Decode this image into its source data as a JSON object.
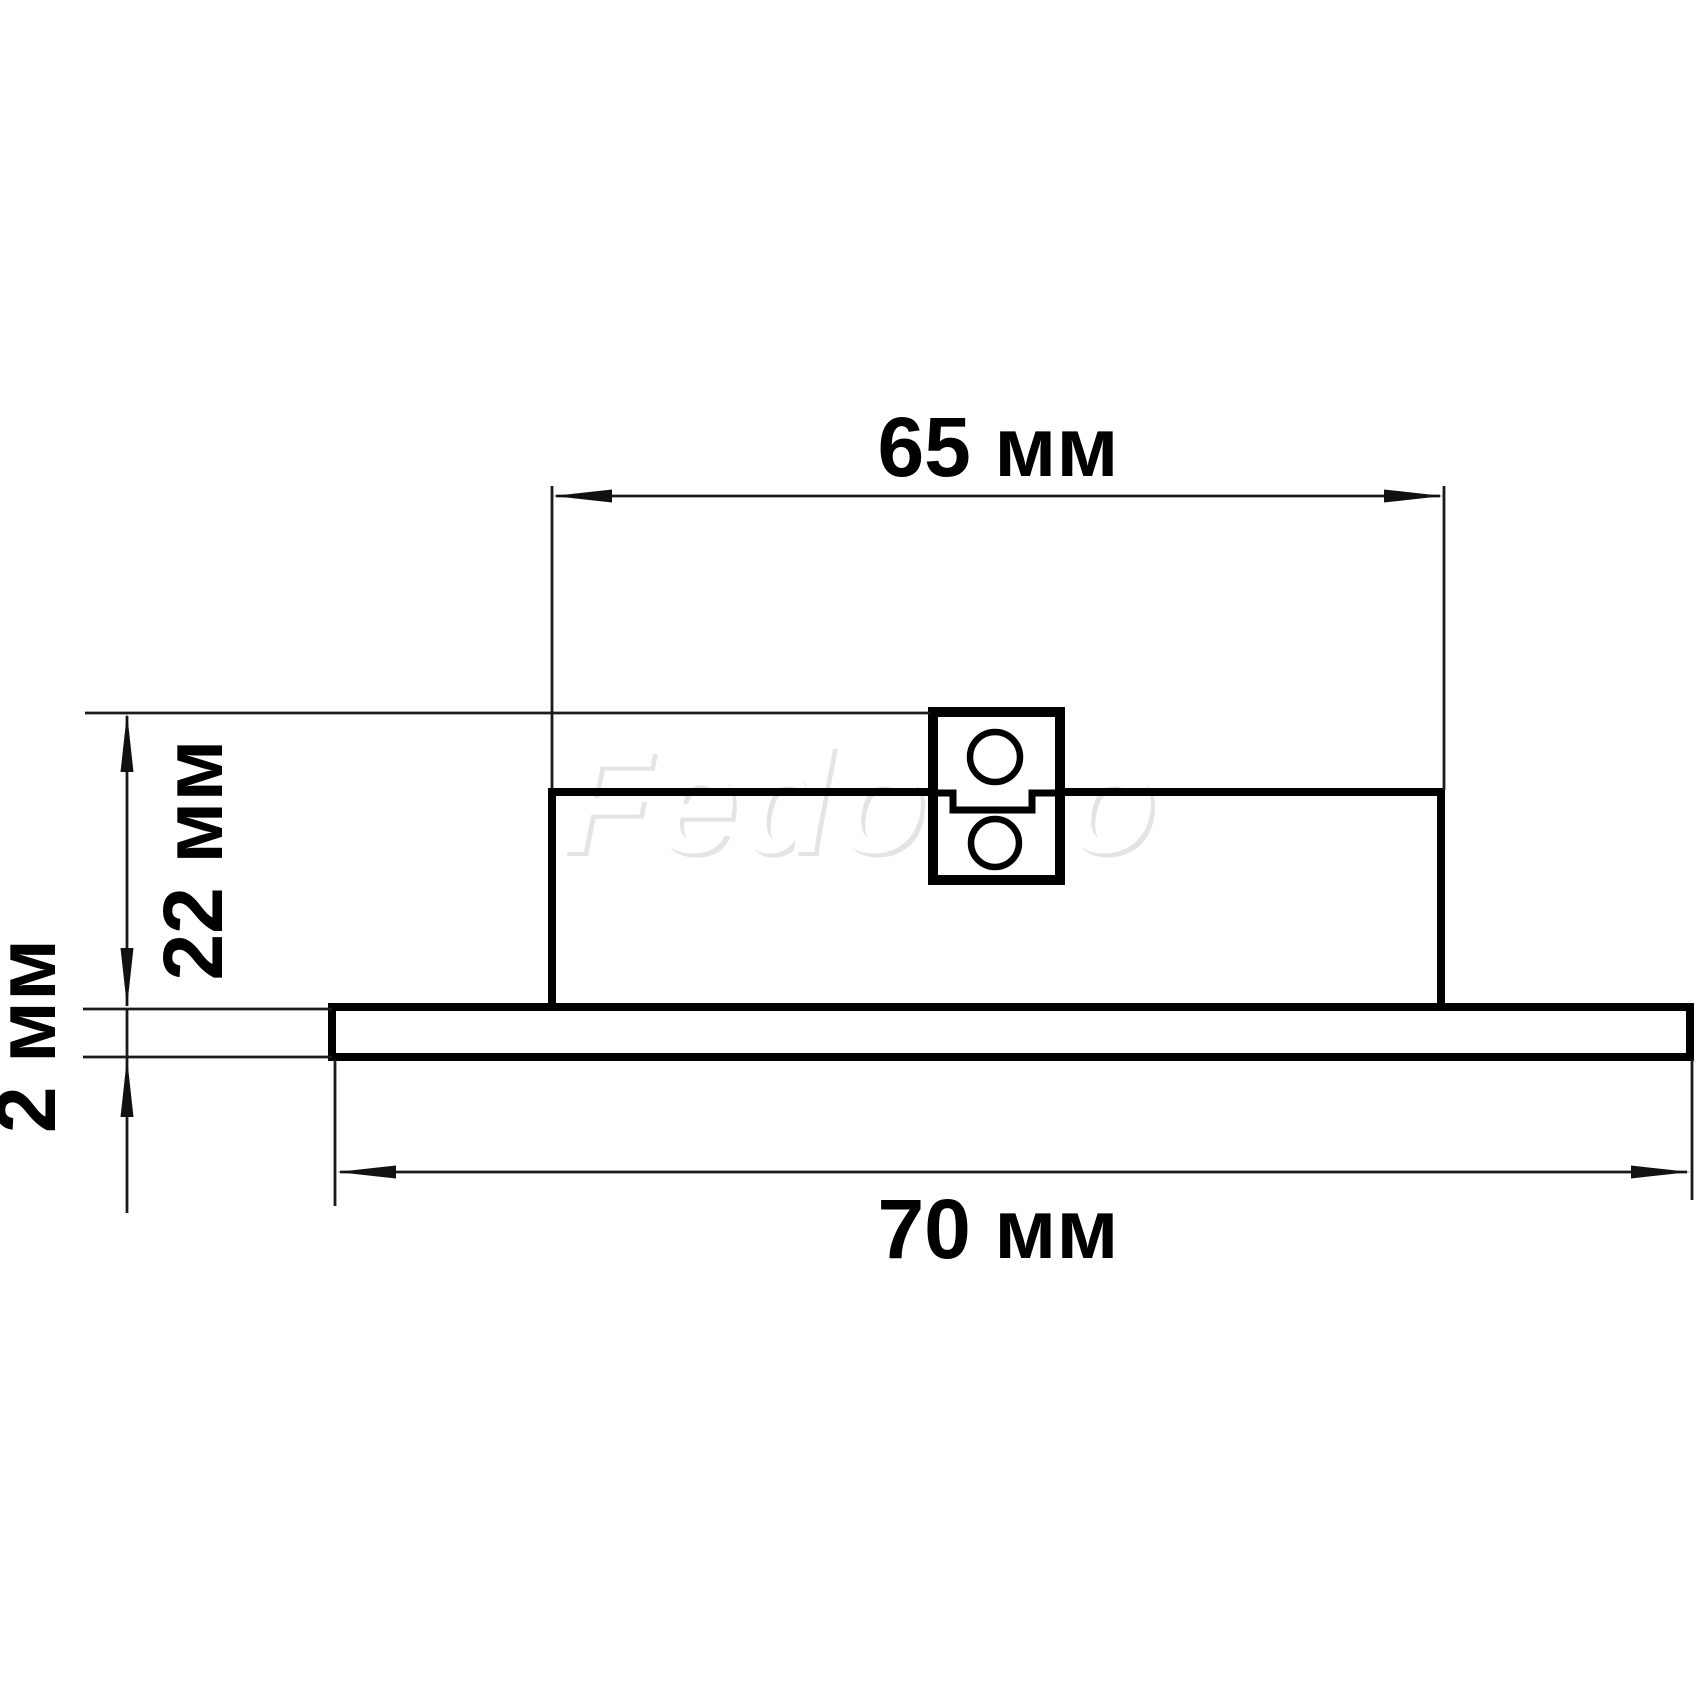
{
  "watermark": {
    "text": "Fedomo"
  },
  "dimensions": {
    "body_width": {
      "value": "65",
      "unit": "мм",
      "label": "65 мм"
    },
    "overall_height": {
      "value": "22",
      "unit": "мм",
      "label": "22 мм"
    },
    "plate_thickness": {
      "value": "2",
      "unit": "мм",
      "label": "2 мм"
    },
    "plate_width": {
      "value": "70",
      "unit": "мм",
      "label": "70 мм"
    }
  },
  "colors": {
    "background": "#ffffff",
    "outline": "#000000",
    "dimension_lines": "#1b1b1b",
    "watermark_shadow": "#e4e4e4"
  }
}
